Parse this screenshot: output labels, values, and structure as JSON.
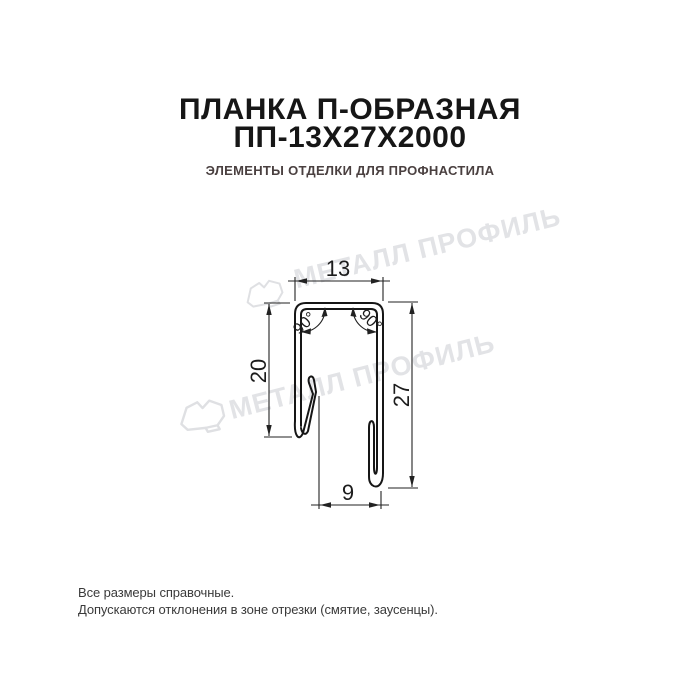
{
  "header": {
    "title_line1": "ПЛАНКА П-ОБРАЗНАЯ",
    "title_line2": "ПП-13Х27Х2000",
    "subtitle": "ЭЛЕМЕНТЫ ОТДЕЛКИ ДЛЯ ПРОФНАСТИЛА"
  },
  "drawing": {
    "dim_top_width": "13",
    "dim_left_height": "20",
    "dim_right_height": "27",
    "dim_bottom_width": "9",
    "angle_left": "90°",
    "angle_right": "90°"
  },
  "watermark": {
    "text": "МЕТАЛЛ ПРОФИЛЬ",
    "color": "#e2e3e6"
  },
  "footer": {
    "line1": "Все размеры справочные.",
    "line2": "Допускаются отклонения в зоне отрезки (смятие, заусенцы)."
  },
  "colors": {
    "title": "#161616",
    "subtitle": "#4a4040",
    "drawing_line": "#161616",
    "dimension_line": "#222222",
    "watermark": "#e2e3e6",
    "footer_text": "#3a3a3a",
    "background": "#ffffff"
  }
}
